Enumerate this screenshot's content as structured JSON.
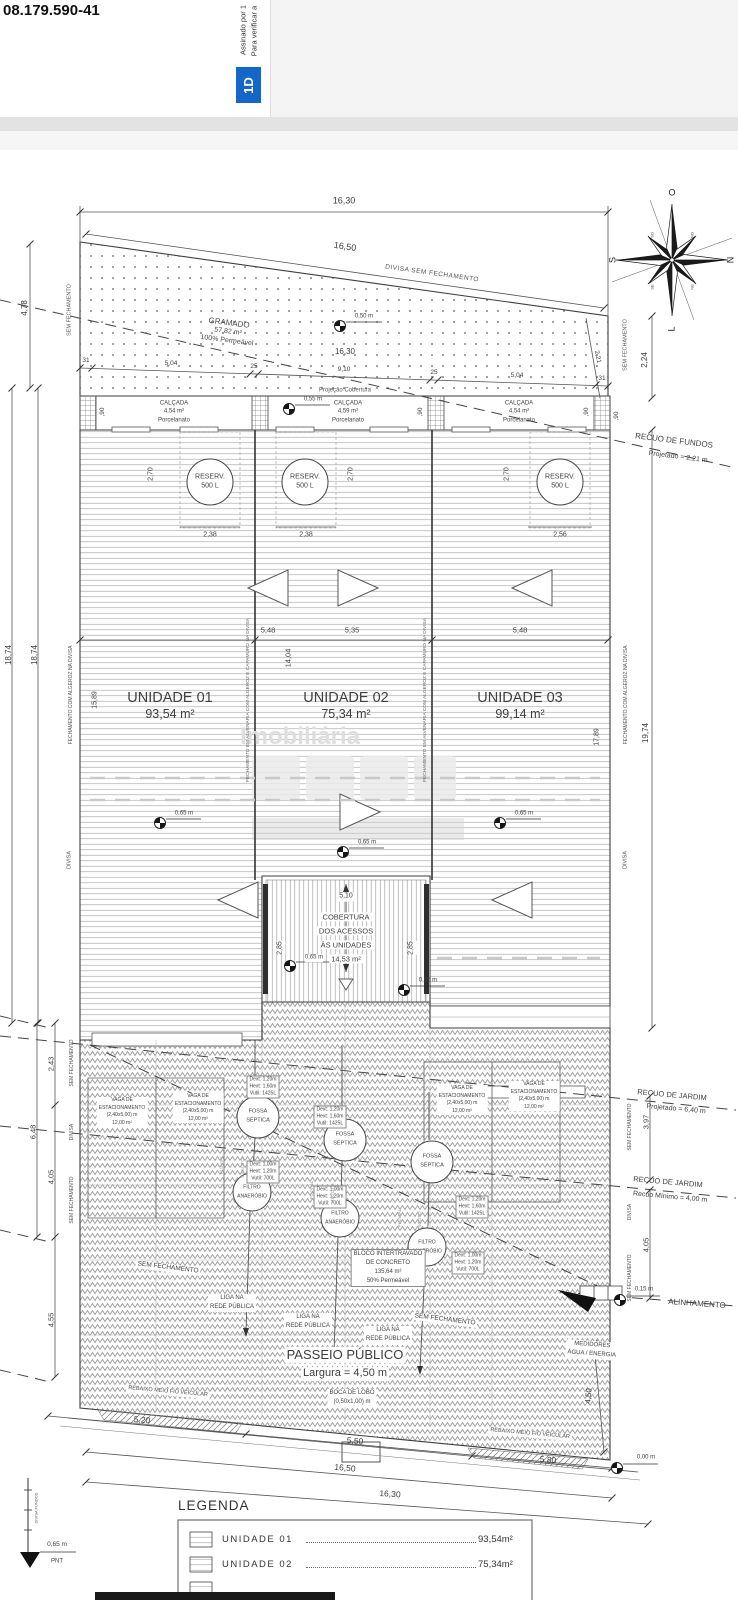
{
  "viewer": {
    "doc_number": "08.179.590-41",
    "signature_line1": "Assinado por 1",
    "signature_line2": "Para verificar a",
    "stamp_glyph": "1D"
  },
  "watermark": {
    "line1": "Imobiliária"
  },
  "compass": {
    "n": "N",
    "s": "S",
    "w": "O",
    "e": "L",
    "nw": "NO",
    "sw": "SO",
    "ne": "NE",
    "se": "SE"
  },
  "top": {
    "dim_total": "16,30",
    "dim_divisa": "16,50",
    "divisa_label": "DIVISA SEM FECHAMENTO",
    "dim_left": "4,78",
    "dim_right": "2,24",
    "dim_diag": "2,21",
    "recuo_fundos_title": "RECUO DE FUNDOS",
    "recuo_fundos_value": "Projetado = 2,21 m"
  },
  "grass": {
    "name": "GRAMADO",
    "area": "57,82 m²",
    "perm": "100% Permeável",
    "dim_inner": "16,30",
    "segments": [
      "31",
      "5,04",
      "25",
      "9,10",
      "25",
      "5,04",
      "31"
    ],
    "projecao": "Projeção Cobertura"
  },
  "levels": {
    "l000": "0,00 m",
    "l015": "0,15 m",
    "l050": "0,50 m",
    "l055": "0,55 m",
    "l065": "0,65 m"
  },
  "calcadas": [
    {
      "title": "CALÇADA",
      "area": "4,54 m²",
      "floor": "Porcelanato",
      "height": ",90"
    },
    {
      "title": "CALÇADA",
      "area": "4,59 m²",
      "floor": "Porcelanato",
      "height": ",90"
    },
    {
      "title": "CALÇADA",
      "area": "4,54 m²",
      "floor": "Porcelanato",
      "height": ",90"
    }
  ],
  "roof": {
    "reserv_title": "RESERV.",
    "reserv_cap": "500 L",
    "reserv_height": "2,70",
    "reserv_widths": [
      "2,38",
      "2,38",
      "2,56"
    ],
    "section_dims": [
      "5,48",
      "5,35",
      "5,48"
    ],
    "depth_dim": "14,04"
  },
  "units": [
    {
      "name": "UNIDADE 01",
      "area": "93,54 m²"
    },
    {
      "name": "UNIDADE 02",
      "area": "75,34 m²"
    },
    {
      "name": "UNIDADE 03",
      "area": "99,14 m²"
    }
  ],
  "margins": {
    "sem_fechamento": "SEM FECHAMENTO",
    "divisa": "DIVISA",
    "fechamento_algeroz": "FECHAMENTO COM ALGEROZ NA DIVISA",
    "fechamento_alvenaria": "FECHAMENTO EM ALVENARIA COM ALGEROZ E CAPAMURO NA DIVISA",
    "left_total_a": "18,74",
    "left_total_b": "18,74",
    "left_inner": "15,89",
    "right_inner": "17,89",
    "right_total": "19,74",
    "left_chain": [
      "2,43",
      "6,48",
      "4,05",
      "4,55"
    ],
    "right_chain": [
      "3,97",
      "4,05"
    ]
  },
  "access_cover": {
    "dim_width": "5,10",
    "line1": "COBERTURA",
    "line2": "DOS ACESSOS",
    "line3": "ÀS UNIDADES",
    "area": "14,53 m²",
    "dim_side": "2,85"
  },
  "parking": {
    "line1": "VAGA DE",
    "line2": "ESTACIONAMENTO",
    "line3": "(2,40x5,00) m",
    "line4": "12,00 m²"
  },
  "sanitation": {
    "fossa_line1": "FOSSA",
    "fossa_line2": "SÉPTICA",
    "filtro_line1": "FILTRO",
    "filtro_line2": "ANAERÓBIO",
    "spec_fossa": [
      "Dext: 1,20m",
      "Hext: 1,60m",
      "Vutil: 1425L"
    ],
    "spec_filtro": [
      "Dext: 1,00m",
      "Hext: 1,20m",
      "Vutil: 700L"
    ],
    "liga_line1": "LIGA NA",
    "liga_line2": "REDE PÚBLICA",
    "pipe_pluvial": "PLUVIAL",
    "pipe_esgoto": "ESGOTO"
  },
  "street": {
    "bloco": [
      "BLOCO INTERTRAVADO",
      "DE CONCRETO",
      "135,64 m²",
      "50% Permeável"
    ],
    "passeio_title": "PASSEIO PÚBLICO",
    "passeio_value": "Largura = 4,50 m",
    "medidores_line1": "MEDIDORES",
    "medidores_line2": "ÁGUA / ENERGIA",
    "boca_line1": "BOCA DE LOBO",
    "boca_line2": "(0,50x1,00) m",
    "rebaixo": "REBAIXO MEIO FIO VEICULAR",
    "alinhamento": "ALINHAMENTO",
    "sem_fechamento": "SEM FECHAMENTO",
    "recuo_jardim1_title": "RECUO DE JARDIM",
    "recuo_jardim1_value": "Projetado = 6,40 m",
    "recuo_jardim2_title": "RECUO DE JARDIM",
    "recuo_jardim2_value": "Recuo Mínimo = 4,00 m",
    "dim_520": "5,20",
    "dim_550": "5,50",
    "dim_1650": "16,50",
    "dim_580": "5,80",
    "dim_1630": "16,30",
    "dim_450": "4,50"
  },
  "benchmark": {
    "divisa_fundos": "DIVISA FUNDOS",
    "level": "0,65 m",
    "pnt": "PNT"
  },
  "legend": {
    "title": "LEGENDA",
    "rows": [
      {
        "label": "UNIDADE 01",
        "value": "93,54m²"
      },
      {
        "label": "UNIDADE 02",
        "value": "75,34m²"
      }
    ]
  }
}
